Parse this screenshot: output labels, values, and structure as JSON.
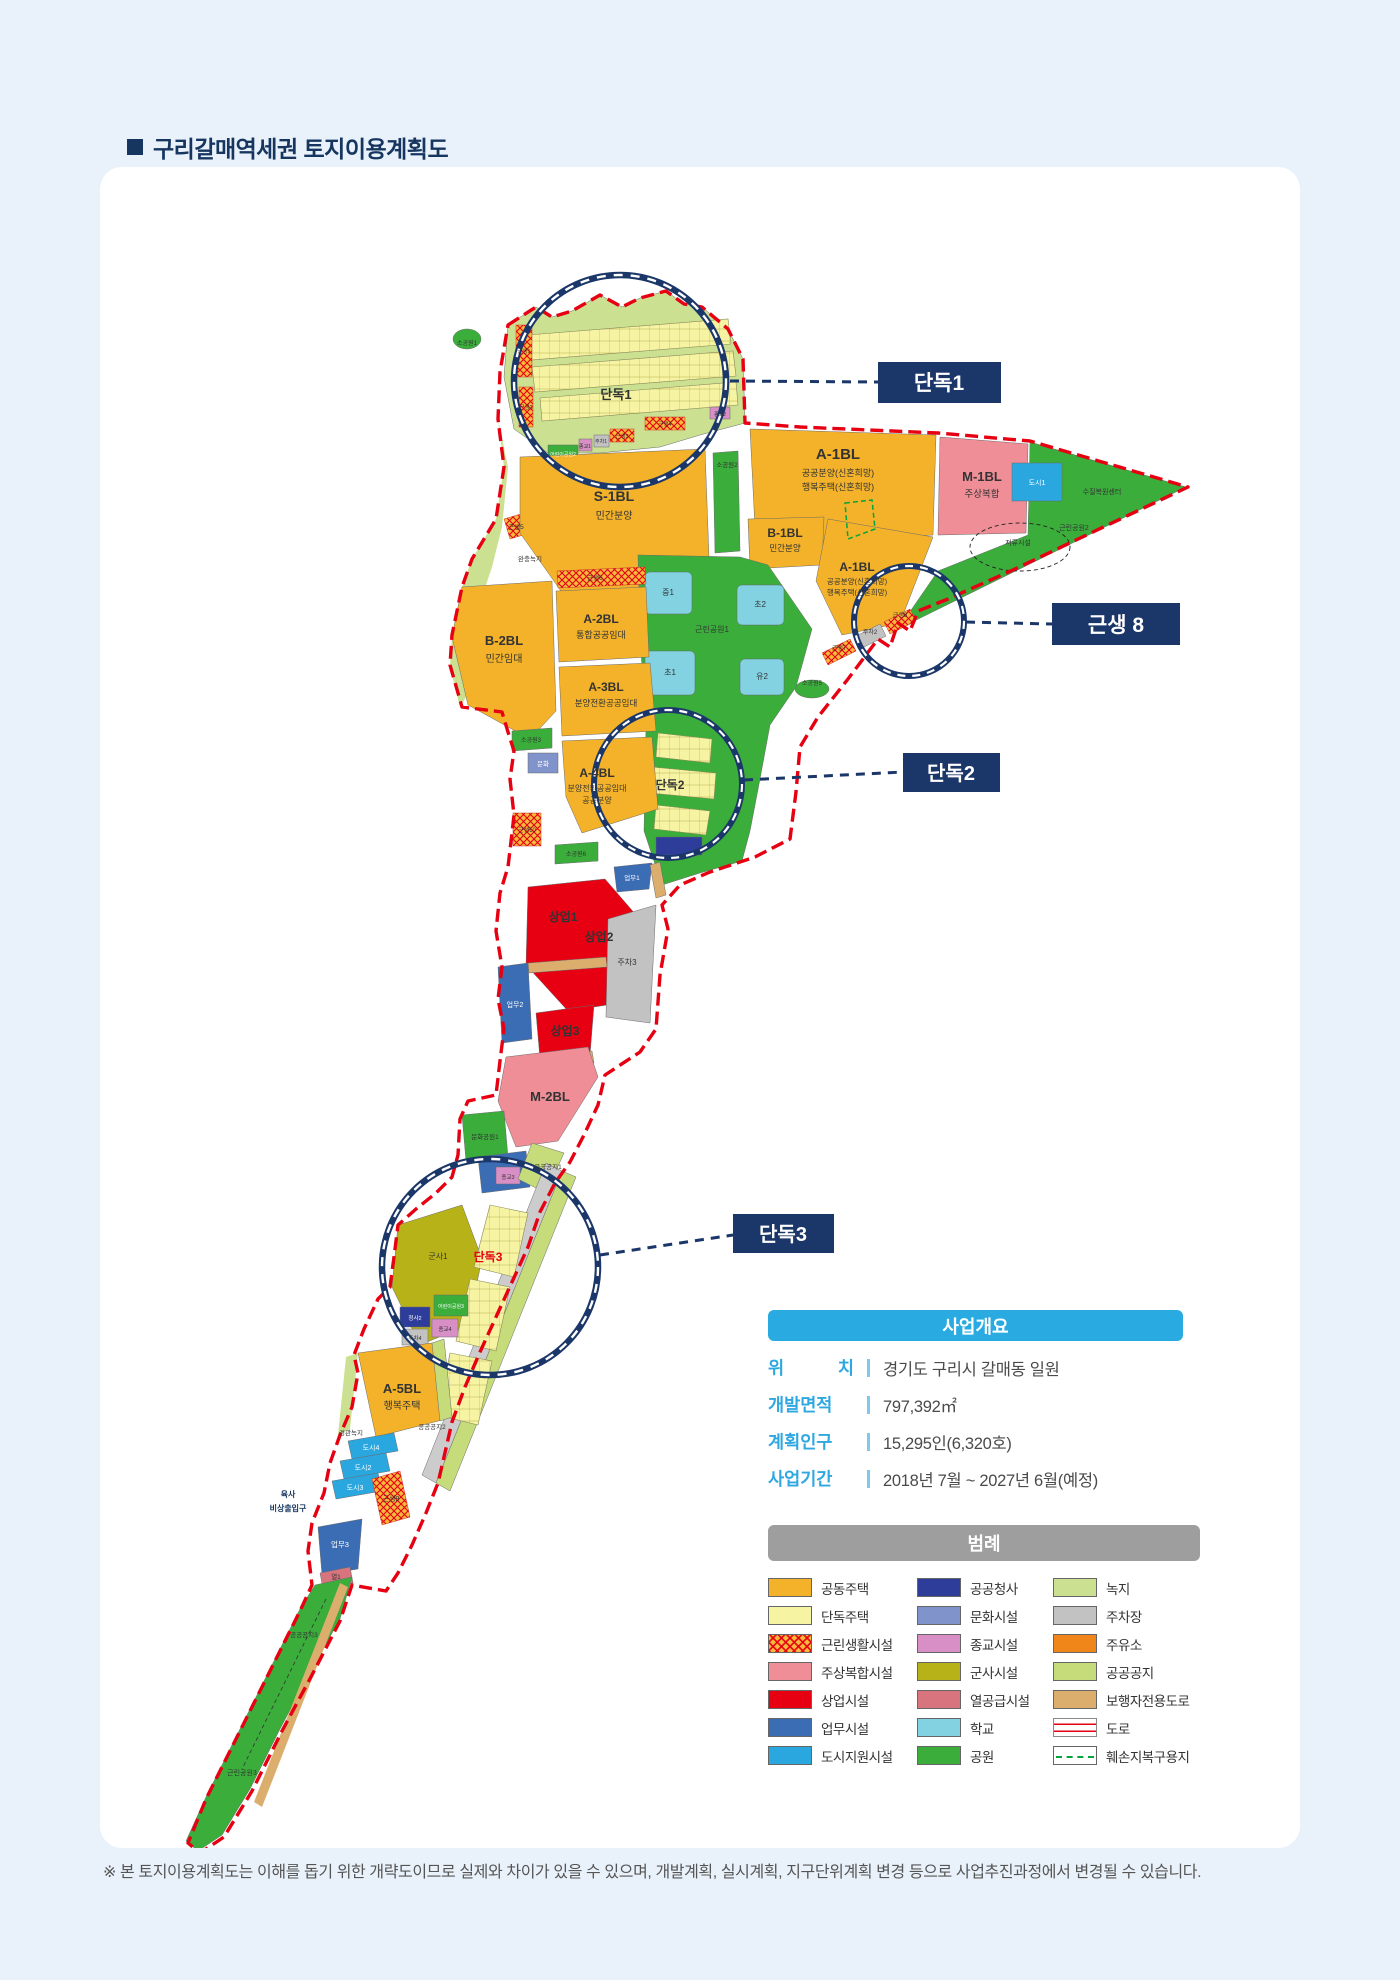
{
  "page": {
    "title": "구리갈매역세권 토지이용계획도",
    "footnote": "※ 본 토지이용계획도는 이해를 돕기 위한 개략도이므로 실제와 차이가 있을 수 있으며, 개발계획, 실시계획, 지구단위계획 변경 등으로 사업추진과정에서 변경될 수 있습니다."
  },
  "colors": {
    "accent_navy": "#1B3668",
    "header_cyan": "#29ABE2",
    "header_gray": "#9E9E9E",
    "boundary_red": "#E60012"
  },
  "callouts": [
    {
      "label": "단독1"
    },
    {
      "label": "근생 8"
    },
    {
      "label": "단독2"
    },
    {
      "label": "단독3"
    }
  ],
  "overview": {
    "header": "사업개요",
    "rows": [
      {
        "label": "위 치",
        "value": "경기도 구리시 갈매동 일원"
      },
      {
        "label": "개발면적",
        "value": "797,392㎡"
      },
      {
        "label": "계획인구",
        "value": "15,295인(6,320호)"
      },
      {
        "label": "사업기간",
        "value": "2018년 7월 ~ 2027년 6월(예정)"
      }
    ]
  },
  "legend": {
    "header": "범례",
    "columns": [
      [
        {
          "name": "공동주택",
          "type": "solid",
          "color": "#F3B229"
        },
        {
          "name": "단독주택",
          "type": "solid",
          "color": "#F6F3A2"
        },
        {
          "name": "근린생활시설",
          "type": "hatch"
        },
        {
          "name": "주상복합시설",
          "type": "solid",
          "color": "#EF8E96"
        },
        {
          "name": "상업시설",
          "type": "solid",
          "color": "#E60012"
        },
        {
          "name": "업무시설",
          "type": "solid",
          "color": "#3B6DB5"
        },
        {
          "name": "도시지원시설",
          "type": "solid",
          "color": "#2BA7E0"
        }
      ],
      [
        {
          "name": "공공청사",
          "type": "solid",
          "color": "#2D3D99"
        },
        {
          "name": "문화시설",
          "type": "solid",
          "color": "#8093CB"
        },
        {
          "name": "종교시설",
          "type": "solid",
          "color": "#D78FC5"
        },
        {
          "name": "군사시설",
          "type": "solid",
          "color": "#B7B218"
        },
        {
          "name": "열공급시설",
          "type": "solid",
          "color": "#D8747D"
        },
        {
          "name": "학교",
          "type": "solid",
          "color": "#82D2E2"
        },
        {
          "name": "공원",
          "type": "solid",
          "color": "#3BAD3B"
        }
      ],
      [
        {
          "name": "녹지",
          "type": "solid",
          "color": "#CBE191"
        },
        {
          "name": "주차장",
          "type": "solid",
          "color": "#C2C2C2"
        },
        {
          "name": "주유소",
          "type": "solid",
          "color": "#F08519"
        },
        {
          "name": "공공공지",
          "type": "solid",
          "color": "#C6DC7A"
        },
        {
          "name": "보행자전용도로",
          "type": "solid",
          "color": "#DCAE6E"
        },
        {
          "name": "도로",
          "type": "road"
        },
        {
          "name": "훼손지복구용지",
          "type": "restore"
        }
      ]
    ]
  },
  "map": {
    "labels": [
      {
        "t": "소공원1",
        "x": 367,
        "y": 178,
        "s": 6
      },
      {
        "t": "근생1",
        "x": 424,
        "y": 186,
        "s": 5.5
      },
      {
        "t": "근생2",
        "x": 426,
        "y": 242,
        "s": 5.5
      },
      {
        "t": "어린이공원2",
        "x": 463,
        "y": 289,
        "s": 5,
        "c": "#fff"
      },
      {
        "t": "종교1",
        "x": 485,
        "y": 281,
        "s": 5
      },
      {
        "t": "주차1",
        "x": 501,
        "y": 276,
        "s": 5
      },
      {
        "t": "근생3",
        "x": 522,
        "y": 271,
        "s": 5.5
      },
      {
        "t": "근생4",
        "x": 565,
        "y": 259,
        "s": 5.5
      },
      {
        "t": "종교2",
        "x": 620,
        "y": 249,
        "s": 5
      },
      {
        "t": "단독1",
        "x": 516,
        "y": 232,
        "s": 13,
        "b": true
      },
      {
        "t": "근생5",
        "x": 416,
        "y": 362,
        "s": 6.5
      },
      {
        "t": "완충녹지",
        "x": 430,
        "y": 394,
        "s": 6.5
      },
      {
        "t": "S-1BL",
        "x": 514,
        "y": 334,
        "s": 14,
        "b": true
      },
      {
        "t": "민간분양",
        "x": 514,
        "y": 352,
        "s": 10
      },
      {
        "t": "소공원2",
        "x": 627,
        "y": 300,
        "s": 6.5
      },
      {
        "t": "A-1BL",
        "x": 738,
        "y": 292,
        "s": 15,
        "b": true
      },
      {
        "t": "공공분양(신혼희망)",
        "x": 738,
        "y": 309,
        "s": 9
      },
      {
        "t": "행복주택(신혼희망)",
        "x": 738,
        "y": 323,
        "s": 9
      },
      {
        "t": "M-1BL",
        "x": 882,
        "y": 314,
        "s": 13,
        "b": true
      },
      {
        "t": "주상복합",
        "x": 882,
        "y": 330,
        "s": 9.5
      },
      {
        "t": "도시1",
        "x": 937,
        "y": 318,
        "s": 7,
        "c": "#fff"
      },
      {
        "t": "수질복원센터",
        "x": 1002,
        "y": 327,
        "s": 7
      },
      {
        "t": "근린공원2",
        "x": 974,
        "y": 363,
        "s": 7
      },
      {
        "t": "저류시설",
        "x": 918,
        "y": 378,
        "s": 7
      },
      {
        "t": "B-1BL",
        "x": 685,
        "y": 370,
        "s": 12,
        "b": true
      },
      {
        "t": "민간분양",
        "x": 685,
        "y": 384,
        "s": 8.5
      },
      {
        "t": "A-1BL",
        "x": 757,
        "y": 404,
        "s": 12,
        "b": true
      },
      {
        "t": "공공분양(신혼희망)",
        "x": 757,
        "y": 417,
        "s": 7.5
      },
      {
        "t": "행복주택(신혼희망)",
        "x": 757,
        "y": 428,
        "s": 7.5
      },
      {
        "t": "근생8",
        "x": 800,
        "y": 450,
        "s": 6
      },
      {
        "t": "주차2",
        "x": 770,
        "y": 467,
        "s": 6
      },
      {
        "t": "근생7",
        "x": 739,
        "y": 483,
        "s": 6
      },
      {
        "t": "소공원5",
        "x": 712,
        "y": 518,
        "s": 6
      },
      {
        "t": "중1",
        "x": 568,
        "y": 428,
        "s": 8
      },
      {
        "t": "초2",
        "x": 660,
        "y": 440,
        "s": 8
      },
      {
        "t": "초1",
        "x": 570,
        "y": 508,
        "s": 8
      },
      {
        "t": "유2",
        "x": 662,
        "y": 512,
        "s": 8
      },
      {
        "t": "근린공원1",
        "x": 612,
        "y": 465,
        "s": 8
      },
      {
        "t": "근생6",
        "x": 495,
        "y": 413,
        "s": 6.5
      },
      {
        "t": "A-2BL",
        "x": 501,
        "y": 456,
        "s": 12,
        "b": true
      },
      {
        "t": "통합공공임대",
        "x": 501,
        "y": 471,
        "s": 9
      },
      {
        "t": "A-3BL",
        "x": 506,
        "y": 524,
        "s": 12,
        "b": true
      },
      {
        "t": "분양전환공공임대",
        "x": 506,
        "y": 539,
        "s": 8.5
      },
      {
        "t": "B-2BL",
        "x": 404,
        "y": 478,
        "s": 13,
        "b": true
      },
      {
        "t": "민간임대",
        "x": 404,
        "y": 495,
        "s": 10
      },
      {
        "t": "소공원3",
        "x": 431,
        "y": 575,
        "s": 6
      },
      {
        "t": "문화",
        "x": 443,
        "y": 599,
        "s": 6.5,
        "c": "#fff"
      },
      {
        "t": "A-4BL",
        "x": 497,
        "y": 610,
        "s": 12,
        "b": true
      },
      {
        "t": "분양전환공공임대",
        "x": 497,
        "y": 624,
        "s": 8
      },
      {
        "t": "공공분양",
        "x": 497,
        "y": 636,
        "s": 8
      },
      {
        "t": "근생10",
        "x": 427,
        "y": 665,
        "s": 6
      },
      {
        "t": "단독2",
        "x": 570,
        "y": 622,
        "s": 12,
        "b": true
      },
      {
        "t": "소공원6",
        "x": 476,
        "y": 689,
        "s": 6
      },
      {
        "t": "업무1",
        "x": 532,
        "y": 713,
        "s": 6.5,
        "c": "#fff"
      },
      {
        "t": "상업1",
        "x": 463,
        "y": 754,
        "s": 12,
        "b": true
      },
      {
        "t": "상업2",
        "x": 499,
        "y": 774,
        "s": 12,
        "b": true
      },
      {
        "t": "주차3",
        "x": 527,
        "y": 798,
        "s": 8
      },
      {
        "t": "업무2",
        "x": 415,
        "y": 840,
        "s": 7,
        "c": "#fff"
      },
      {
        "t": "상업3",
        "x": 465,
        "y": 868,
        "s": 12,
        "b": true
      },
      {
        "t": "M-2BL",
        "x": 450,
        "y": 934,
        "s": 13,
        "b": true
      },
      {
        "t": "문화공원1",
        "x": 385,
        "y": 972,
        "s": 6.5
      },
      {
        "t": "공공공지1",
        "x": 448,
        "y": 1002,
        "s": 6.5
      },
      {
        "t": "종교3",
        "x": 408,
        "y": 1012,
        "s": 5.5
      },
      {
        "t": "군사1",
        "x": 338,
        "y": 1092,
        "s": 8
      },
      {
        "t": "단독3",
        "x": 388,
        "y": 1094,
        "s": 12,
        "c": "#E60012",
        "b": true
      },
      {
        "t": "어린이공원3",
        "x": 351,
        "y": 1141,
        "s": 5,
        "c": "#fff"
      },
      {
        "t": "청사2",
        "x": 315,
        "y": 1153,
        "s": 5.5,
        "c": "#fff"
      },
      {
        "t": "종교4",
        "x": 345,
        "y": 1164,
        "s": 5.5
      },
      {
        "t": "주차4",
        "x": 315,
        "y": 1173,
        "s": 5.5
      },
      {
        "t": "A-5BL",
        "x": 302,
        "y": 1226,
        "s": 13,
        "b": true
      },
      {
        "t": "행복주택",
        "x": 302,
        "y": 1242,
        "s": 10
      },
      {
        "t": "경관녹지",
        "x": 251,
        "y": 1268,
        "s": 6.5
      },
      {
        "t": "공공공지2",
        "x": 332,
        "y": 1262,
        "s": 6.5
      },
      {
        "t": "도시4",
        "x": 271,
        "y": 1283,
        "s": 7,
        "c": "#fff"
      },
      {
        "t": "도시2",
        "x": 263,
        "y": 1303,
        "s": 7,
        "c": "#fff"
      },
      {
        "t": "도시3",
        "x": 255,
        "y": 1323,
        "s": 7,
        "c": "#fff"
      },
      {
        "t": "근생9",
        "x": 291,
        "y": 1334,
        "s": 7
      },
      {
        "t": "육사",
        "x": 188,
        "y": 1330,
        "s": 8,
        "c": "#16355F",
        "b": true
      },
      {
        "t": "비상출입구",
        "x": 188,
        "y": 1344,
        "s": 8,
        "c": "#16355F",
        "b": true
      },
      {
        "t": "업무3",
        "x": 240,
        "y": 1380,
        "s": 7.5,
        "c": "#fff"
      },
      {
        "t": "열1",
        "x": 236,
        "y": 1412,
        "s": 6.5
      },
      {
        "t": "공공공지3",
        "x": 204,
        "y": 1470,
        "s": 6.5
      },
      {
        "t": "근린공원3",
        "x": 142,
        "y": 1608,
        "s": 7
      }
    ]
  }
}
